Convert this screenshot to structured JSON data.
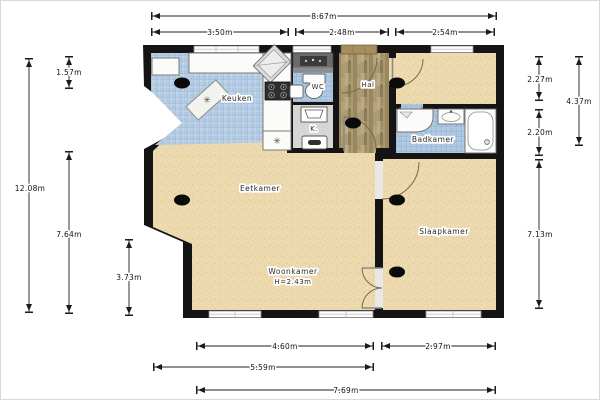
{
  "plan": {
    "rooms": {
      "keuken": "Keuken",
      "wc": "WC",
      "hal": "Hal",
      "kast": "K.",
      "badkamer": "Badkamer",
      "eetkamer": "Eetkamer",
      "woonkamer": "Woonkamer",
      "woonkamer_ceiling": "H=2.43m",
      "slaapkamer": "Slaapkamer"
    },
    "dimensions": {
      "top_total": "8.67m",
      "top_seg1": "3.50m",
      "top_seg2": "2.48m",
      "top_seg3": "2.54m",
      "left_total": "12.08m",
      "left_top": "1.57m",
      "left_mid": "7.64m",
      "left_bottom": "3.73m",
      "right_top": "2.27m",
      "right_combined": "4.37m",
      "right_mid": "2.20m",
      "right_bottom": "7.13m",
      "bottom_seg1": "4.60m",
      "bottom_seg2": "2.97m",
      "bottom_sub": "5.59m",
      "bottom_total": "7.69m"
    },
    "icons": {
      "service_point": "✳"
    },
    "colors": {
      "wall": "#141414",
      "floor_tan": "#ecd9ad",
      "kitchen_tile": "#b9cfe5",
      "bath_tile": "#aec7e1",
      "hal_wood": "#ab9971",
      "fixture_white": "#fbfbfa"
    }
  }
}
